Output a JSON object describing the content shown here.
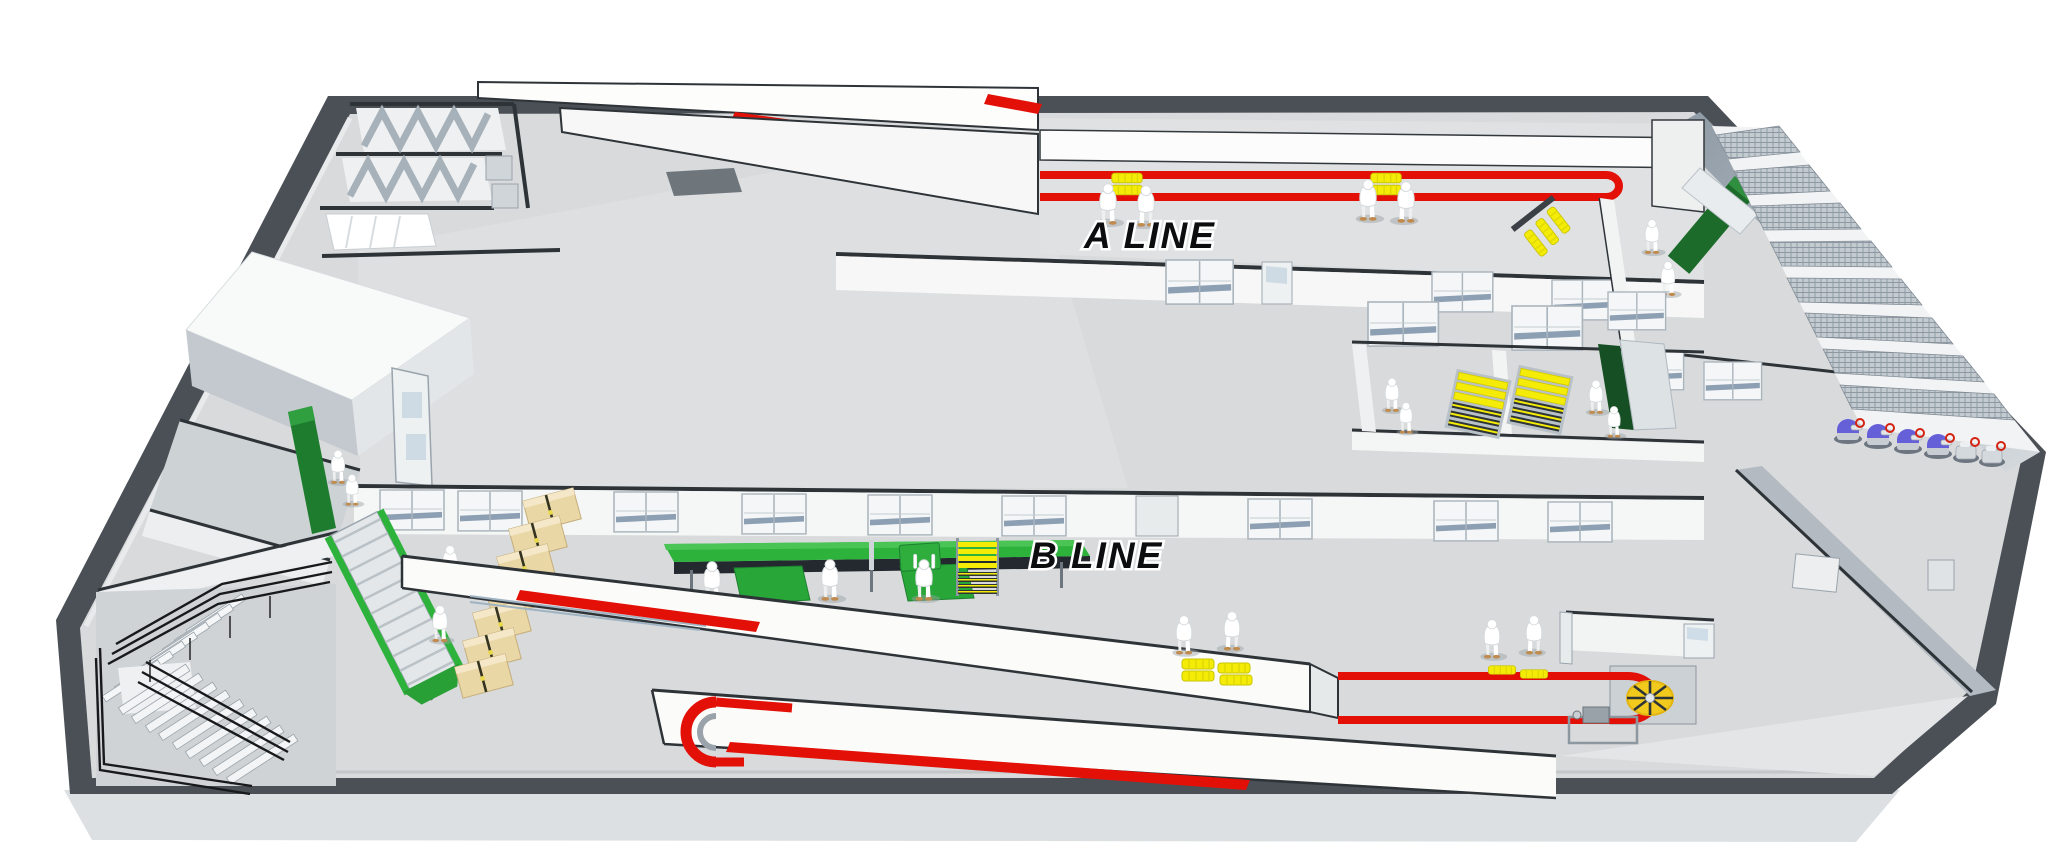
{
  "labels": {
    "a_line": "A LINE",
    "b_line": "B LINE"
  },
  "palette": {
    "background": "#ffffff",
    "floor": "#d8dadb",
    "outer_wall": "#4a5056",
    "wall_face_blue": "#9fa9b3",
    "white_wall": "#fbfcfa",
    "conveyor_red": "#e31008",
    "work_table_green": "#2db33c",
    "inspection_table_dark_green": "#1c6b2b",
    "tray_yellow": "#f4ec06",
    "carton_tan": "#ead7a6",
    "machine_dome_blue": "#655fd8",
    "turntable_yellow": "#f2ca1e",
    "railing_black": "#17191b"
  }
}
